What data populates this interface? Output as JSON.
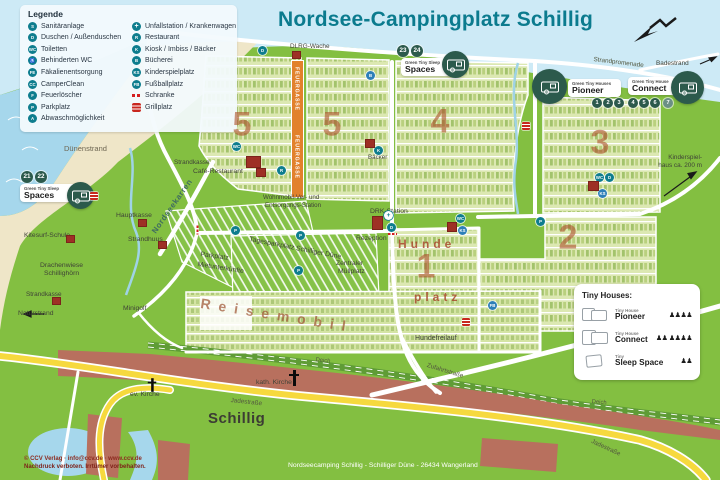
{
  "title": "Nordsee-Campingplatz Schillig",
  "legend": {
    "heading": "Legende",
    "left": [
      {
        "name": "sanitaeranlage",
        "glyph": "S",
        "label": "Sanitäranlage"
      },
      {
        "name": "duschen",
        "glyph": "D",
        "label": "Duschen / Außenduschen"
      },
      {
        "name": "toiletten",
        "glyph": "WC",
        "label": "Toiletten"
      },
      {
        "name": "behinderten-wc",
        "glyph": "♿",
        "label": "Behinderten WC"
      },
      {
        "name": "faekalienentsorgung",
        "glyph": "FE",
        "label": "Fäkalienentsorgung"
      },
      {
        "name": "camperclean",
        "glyph": "CC",
        "label": "CamperClean"
      },
      {
        "name": "feuerloescher",
        "glyph": "F",
        "label": "Feuerlöscher"
      },
      {
        "name": "parkplatz",
        "glyph": "P",
        "label": "Parkplatz"
      },
      {
        "name": "abwaschmoeglichkeit",
        "glyph": "A",
        "label": "Abwaschmöglichkeit"
      }
    ],
    "right": [
      {
        "name": "unfallstation",
        "glyph": "+",
        "label": "Unfallstation / Krankenwagen"
      },
      {
        "name": "restaurant",
        "glyph": "R",
        "label": "Restaurant"
      },
      {
        "name": "kiosk",
        "glyph": "K",
        "label": "Kiosk / Imbiss / Bäcker"
      },
      {
        "name": "buecherei",
        "glyph": "B",
        "label": "Bücherei"
      },
      {
        "name": "kinderspielplatz",
        "glyph": "KS",
        "label": "Kinderspielplatz"
      },
      {
        "name": "fussballplatz",
        "glyph": "FB",
        "label": "Fußballplatz"
      },
      {
        "name": "schranke",
        "glyph": "",
        "label": "Schranke"
      },
      {
        "name": "grillplatz",
        "glyph": "",
        "label": "Grillplatz"
      }
    ]
  },
  "icons": {
    "shower": "D",
    "wc": "WC",
    "restaurant": "R",
    "library": "B",
    "kiosk": "K",
    "playground": "KS",
    "soccer": "FB",
    "parking": "P",
    "cross": "+"
  },
  "zones": {
    "z5": "5",
    "z4": "4",
    "z3": "3",
    "z2": "2",
    "z1": "1"
  },
  "badges": {
    "spaces_left": {
      "line1": "Green Tiny Sleep",
      "line2": "Spaces",
      "numbers": [
        "21",
        "22"
      ]
    },
    "spaces_top": {
      "line1": "Green Tiny Sleep",
      "line2": "Spaces",
      "numbers": [
        "23",
        "24"
      ]
    },
    "pioneer": {
      "line1": "Green Tiny Houses",
      "line2": "Pioneer"
    },
    "connect": {
      "line1": "Green Tiny House",
      "line2": "Connect"
    },
    "house_numbers": [
      "1",
      "2",
      "3",
      "4",
      "5",
      "6",
      "7"
    ]
  },
  "labels": {
    "duenenstrand": "Dünenstrand",
    "dlrg": "DLRG-Wache",
    "strandpromenade": "Strandpromenade",
    "badestrand": "Badestrand",
    "kinderspielhaus1": "Kinderspiel-",
    "kinderspielhaus2": "haus ca. 200 m",
    "strandkasse": "Strandkasse",
    "cafe": "Café-Restaurant",
    "nordseekarren": "Nordseekarren",
    "hauptkasse": "Hauptkasse",
    "strandhuus": "Strandhuus",
    "kitesurf": "Kitesurf-Schule",
    "drachenwiese1": "Drachenwiese",
    "drachenwiese2": "Schillighörn",
    "naturstrand": "Naturstrand",
    "minigolf": "Minigolf",
    "parkplatz": "Parkplatz",
    "mietunterkuenfte": "Mietunterkünfte",
    "tagesparkplatz": "Tagesparkplatz Schilliger Düne",
    "muellplatz1": "Zentraler",
    "muellplatz2": "Müllplatz",
    "rezeption": "Rezeption",
    "drk": "DRK-Station",
    "wohnmobil1": "Wohnmobil-Ver- und",
    "wohnmobil2": "Entsorgungs-Station",
    "baecker": "Bäcker",
    "hunde1": "Hunde",
    "hunde2": "platz",
    "hundefreilauf": "Hundefreilauf",
    "zufahrtstrasse": "Zufahrtstraße",
    "jadestrasse": "Jadestraße",
    "deich": "Deich",
    "kath_kirche": "kath. Kirche",
    "ev_kirche": "ev. Kirche",
    "schillig": "Schillig",
    "feuergasse": "FEUERGASSE",
    "reisemobil": "Reisemobil"
  },
  "tiny_houses": {
    "heading": "Tiny Houses:",
    "rows": [
      {
        "type": "Tiny House",
        "name": "Pioneer",
        "persons": "♟♟♟♟"
      },
      {
        "type": "Tiny House",
        "name": "Connect",
        "persons": "♟♟ ♟♟♟♟"
      },
      {
        "type": "Tiny",
        "name": "Sleep Space",
        "persons": "♟♟"
      }
    ]
  },
  "footer": {
    "copyright1": "© CCV Verlag · info@ccv.de · www.ccv.de",
    "copyright2": "Nachdruck verboten. Irrtümer vorbehalten.",
    "address": "Nordseecamping Schillig - Schilliger Düne - 26434 Wangerland"
  },
  "colors": {
    "title": "#0b7b8e",
    "accent_teal": "#0e7d8e",
    "badge_green": "#2c5a4c",
    "zone_number": "#ad542d",
    "brick": "#b8705e",
    "road_yellow": "#f6d93e"
  }
}
